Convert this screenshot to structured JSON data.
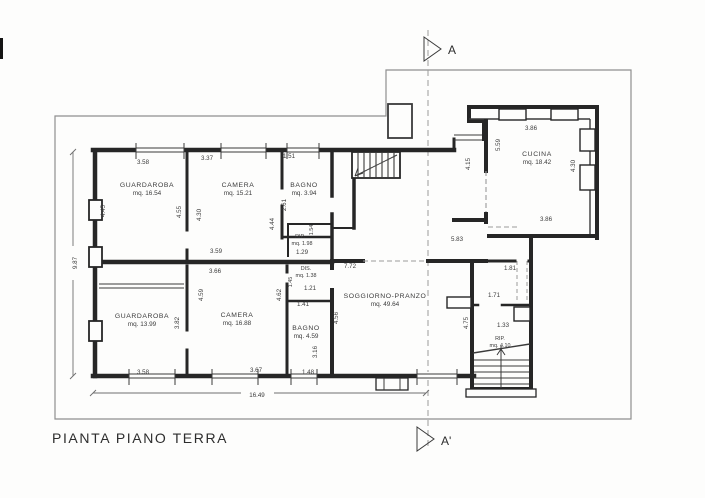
{
  "title": "PIANTA PIANO TERRA",
  "section": {
    "top": "A",
    "bottom": "A'"
  },
  "rooms": {
    "guardaroba1": {
      "name": "GUARDAROBA",
      "area": "mq. 16.54"
    },
    "camera1": {
      "name": "CAMERA",
      "area": "mq. 15.21"
    },
    "bagno1": {
      "name": "BAGNO",
      "area": "mq. 3.94"
    },
    "rip1": {
      "name": "RIP.",
      "area": "mq. 1.98"
    },
    "dis": {
      "name": "DIS.",
      "area": "mq. 1.38"
    },
    "guardaroba2": {
      "name": "GUARDAROBA",
      "area": "mq. 13.99"
    },
    "camera2": {
      "name": "CAMERA",
      "area": "mq. 16.88"
    },
    "bagno2": {
      "name": "BAGNO",
      "area": "mq. 4.59"
    },
    "soggiorno": {
      "name": "SOGGIORNO-PRANZO",
      "area": "mq. 49.64"
    },
    "cucina": {
      "name": "CUCINA",
      "area": "mq. 18.42"
    },
    "rip2": {
      "name": "RIP.",
      "area": "mq. 4.10"
    }
  },
  "dims": {
    "top_guardaroba_w": "3.58",
    "top_camera_w": "3.37",
    "top_bagno_w": "1.51",
    "camera1_bottom": "3.59",
    "rip1_w": "1.29",
    "rip1_h": "1.54",
    "guardaroba1_left": "4.45",
    "guardaroba1_right": "4.55",
    "camera1_left": "4.30",
    "camera1_right": "4.44",
    "bagno1_left": "2.61",
    "overall_left": "9.87",
    "camera2_top": "3.66",
    "dis_w": "1.21",
    "dis_h": "1.45",
    "bagno2_top": "1.41",
    "guardaroba2_right": "3.82",
    "camera2_left": "4.59",
    "camera2_right": "4.62",
    "bagno2_right": "3.16",
    "guardaroba2_bottom": "3.58",
    "camera2_bottom": "3.67",
    "bagno2_bottom": "1.48",
    "overall_bottom": "16.49",
    "soggiorno_top": "7.72",
    "hall_w": "5.83",
    "soggiorno_left": "4.56",
    "soggiorno_right": "4.75",
    "passage_a": "1.81",
    "passage_b": "1.71",
    "rip2_w": "1.33",
    "cucina_top": "3.86",
    "cucina_bottom": "3.86",
    "cucina_left_inner": "5.59",
    "cucina_right": "4.30",
    "hall_right": "4.15"
  }
}
